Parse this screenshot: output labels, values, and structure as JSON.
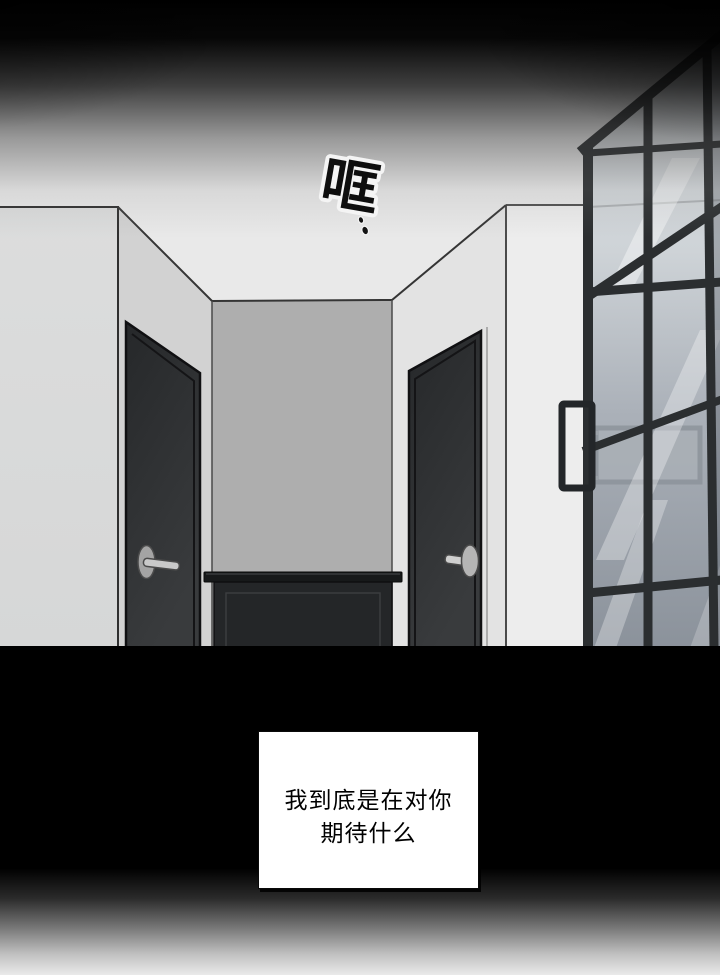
{
  "sfx": {
    "text": "哐",
    "drip_dots": 2
  },
  "caption": {
    "line1": "我到底是在对你",
    "line2": "期待什么"
  },
  "palette": {
    "vignette_black": "#000000",
    "ceiling_light": "#e9e9e9",
    "left_wall": "#d9dadb",
    "inner_left_wall": "#d2d2d2",
    "back_wall": "#aeaeae",
    "inner_right_wall": "#e3e3e3",
    "right_wall": "#ededed",
    "door_dark": "#2f3133",
    "cabinet_dark": "#242628",
    "window_frame": "#2b2e30",
    "glass_top": "#e2e5e7",
    "glass_bottom": "#8b929b",
    "handle_metal": "#c9c9c9",
    "caption_bg": "#ffffff",
    "caption_text": "#000000",
    "sfx_fill": "#0e0e0e",
    "sfx_outline": "#f4f4f4"
  }
}
